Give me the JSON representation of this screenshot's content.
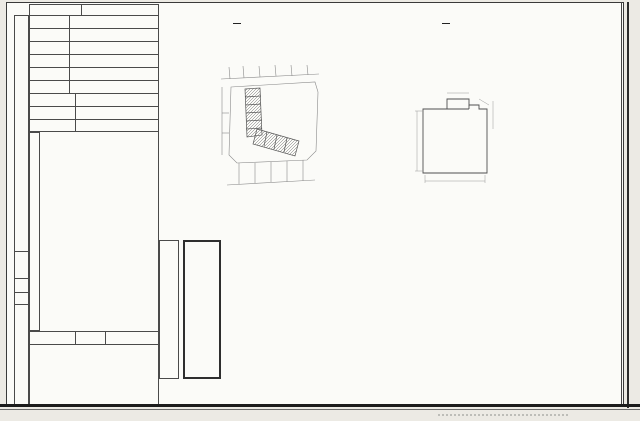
{
  "topbar": {
    "survey_label": "測 量 日 期",
    "y": "86",
    "u1": "年",
    "m": "12",
    "u2": "月",
    "d": "8",
    "u3": "日"
  },
  "scalebar": {
    "loc_label": "位置圖",
    "scale_label": "比例尺：",
    "loc_num": "1",
    "loc_den": "1200",
    "cad_label": "地籍圖",
    "cad_no": "9",
    "cad_suffix": "號",
    "plan_label": "平面圖",
    "plan_scale_label": "比例尺：",
    "plan_num": "1",
    "plan_den": "200",
    "calc_label": "面積計算式"
  },
  "site": {
    "side": "基地坐落",
    "r1_label": "鄉鎮市區",
    "r1_value": "五結",
    "r2_label": "段 小段",
    "r2_seg1": "下清水",
    "r2_u1": "段",
    "r2_seg2": "寶斗厝",
    "r2_u2": "小段",
    "r3_label": "地　號",
    "r3_value": "65",
    "r3_suffix": "地號"
  },
  "addr": {
    "side": "建物門牌",
    "r1_label": "街　路",
    "r1_value": "下清",
    "r1_suffix": "街路",
    "r2_label": "段巷弄",
    "r2_value": "段　　巷　　弄",
    "r3_label": "門　牌",
    "r3_value": "96",
    "r3_mid": "號",
    "r3_value2": "11F-9",
    "r3_suffix": "樓"
  },
  "simple": {
    "r1_label": "主體構造",
    "r1_value": "R.C造",
    "r2_label": "主要用途",
    "r2_value": "鄉村住宅",
    "r3_label": "使用執照",
    "r3_value": "建局營字5522號"
  },
  "floors": {
    "side1": "層　面　積",
    "side2": "（平方公尺）",
    "unit": "平方公尺",
    "rows": [
      {
        "label": "地面層",
        "value": "·",
        "hand": "false"
      },
      {
        "label": "",
        "value": "·",
        "hand": "false"
      },
      {
        "label": "",
        "value": "·",
        "hand": "false"
      },
      {
        "label": "",
        "value": "·",
        "hand": "false"
      },
      {
        "label": "",
        "value": "·",
        "hand": "false"
      },
      {
        "label": "第七層",
        "value": "·",
        "hand": "false"
      },
      {
        "label": "第八層",
        "value": "·",
        "hand": "false"
      },
      {
        "label": "第九層",
        "value": "·",
        "hand": "false"
      },
      {
        "label": "第十層",
        "value": "·",
        "hand": "false"
      },
      {
        "label": "第十一層",
        "value": "23.47",
        "hand": "true"
      },
      {
        "label": "第十二層",
        "value": "·",
        "hand": "false"
      },
      {
        "label": "",
        "value": "·",
        "hand": "false"
      },
      {
        "label": "",
        "value": "·",
        "hand": "false"
      },
      {
        "label": "地下一層",
        "value": "·",
        "hand": "false"
      },
      {
        "label": "地下二層",
        "value": "·",
        "hand": "false"
      },
      {
        "label": "騎　樓",
        "value": "·",
        "hand": "false"
      },
      {
        "label": "合　計",
        "value": "23.47",
        "hand": "true"
      }
    ]
  },
  "apply": {
    "l1": "申請書",
    "l2": "收件日期",
    "date": "11 10",
    "no_label": "字　號",
    "no": "718"
  },
  "annex": {
    "side": "附屬建物",
    "h1": "主要用途",
    "h2": "主體構造",
    "h3": "面　積",
    "unit": "平方公尺",
    "rows": [
      {
        "usage": "十一層陽台",
        "struct": "R.C造",
        "area": "4.18",
        "hand": "true"
      },
      {
        "usage": "",
        "struct": "",
        "area": "·",
        "hand": "false"
      },
      {
        "usage": "",
        "struct": "",
        "area": "·",
        "hand": "false"
      },
      {
        "usage": "",
        "struct": "",
        "area": "·",
        "hand": "false"
      },
      {
        "usage": "合　計",
        "struct": "",
        "area": "4.18",
        "hand": "true"
      }
    ]
  },
  "road_label": "下清路",
  "map": {
    "lot_a": "690",
    "lot_b": "65"
  },
  "plan": {
    "floor": "十一層",
    "balcony": "陽台",
    "dim_left": "8.06",
    "dim_bottom": "4.00",
    "dim_t1": "0.94",
    "dim_t2": "1.40",
    "dim_r1": "0.30",
    "dim_r2": "2.40"
  },
  "cert": {
    "col1": "本建物平面圖及建物面積係依使用",
    "col2_pre": "執照　年　月　日",
    "col2_fill": "建局營",
    "col2_mid": "字第",
    "col2_no": "5522",
    "col2_end": "號",
    "strip": "設計圖或竣工平面圖轉繪計算"
  },
  "annot": {
    "added": "追加登錄",
    "a1": "五結",
    "a2": "成興",
    "a3": "離",
    "a4": "讚",
    "a5": "申 月 20 日",
    "a6": "11F之9",
    "a7": "代理人",
    "a8": "申請人"
  },
  "calc": {
    "l1_label": "十一層：",
    "l1": "(8.06×4.00)－〔1.40×(0.94＋1.90)÷2〕＝23.47 m²",
    "l2_label": "合　計：",
    "l2_value": "23.47 m²",
    "l3_label": "十一層陽台：",
    "l3": "〔(1.40＋1.90)×0.50÷2〕＋(0.94×2.40)＋〔(1.90＋0.30)×0.30÷2〕＝4.18 m²",
    "l4_label": "合　計：",
    "l4_value": "4.18 m²"
  },
  "notes": {
    "n1_pre": "1.本建物係",
    "n1_f1": "14",
    "n1_mid": "層建物本件僅測量第",
    "n1_f2": "11",
    "n1_end": "層部分。",
    "n2": "2.本成果表以建物登記為限。"
  }
}
